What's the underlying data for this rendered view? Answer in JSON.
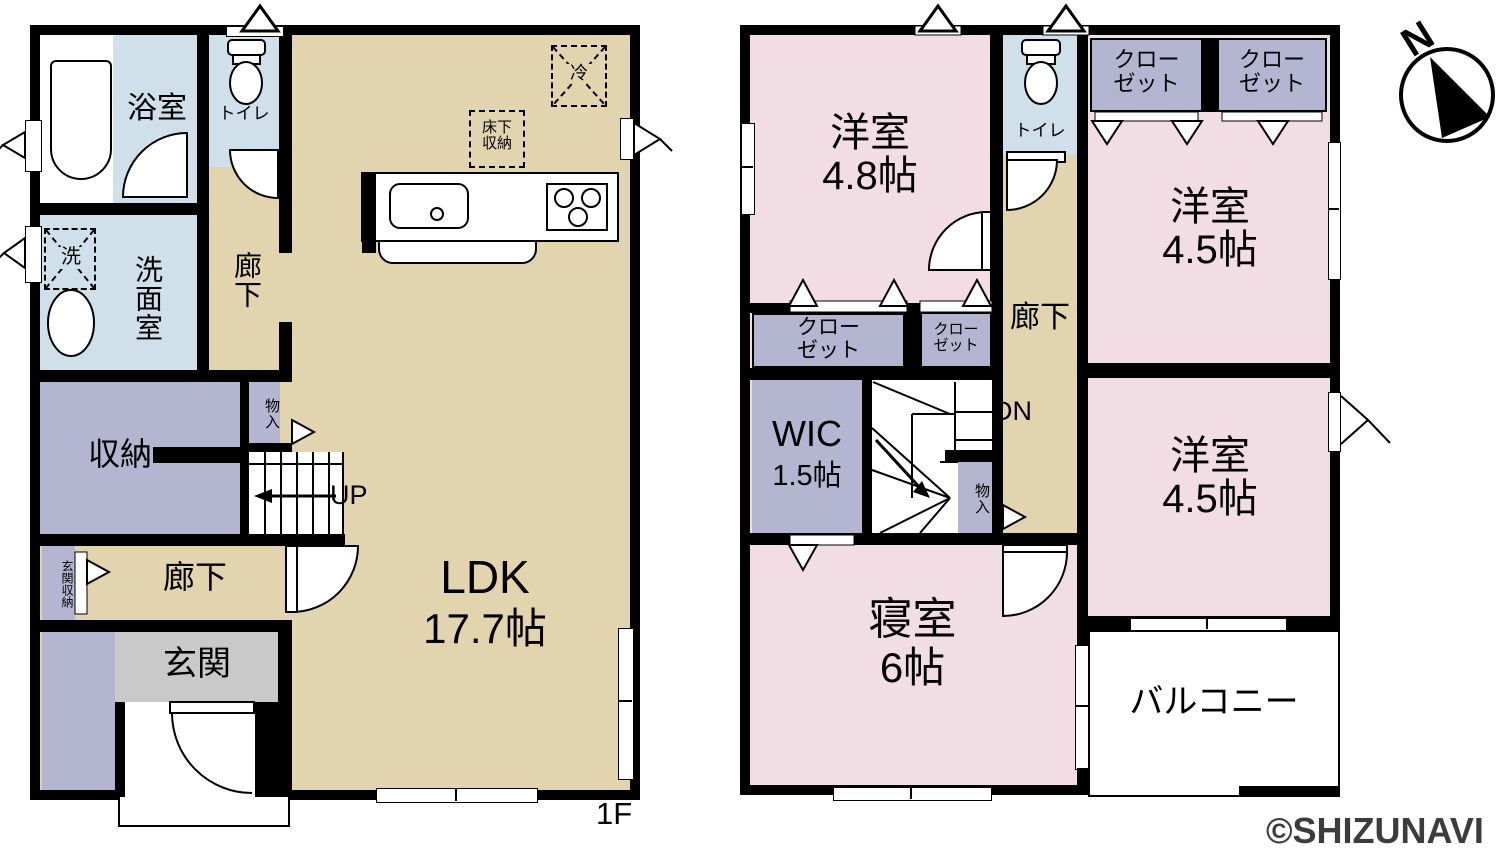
{
  "colors": {
    "wall": "#000000",
    "floor_tan": "#e2d4ae",
    "wet_area_blue": "#cfe0ea",
    "storage_lavender": "#b4b6d1",
    "room_pink": "#f2dde5",
    "entrance_gray": "#c9c9c9",
    "watermark_gray": "#3c3c3c"
  },
  "compass": {
    "north_label": "N"
  },
  "watermark": {
    "text": "©SHIZUNAVI"
  },
  "floor1": {
    "floor_label": "1F",
    "rooms": {
      "bath": "浴室",
      "toilet": "トイレ",
      "hall_upper": "廊下",
      "washroom": "洗面室",
      "washer": "洗",
      "storage": "収納",
      "closet_small": "物入",
      "stairs_up": "UP",
      "entry_storage": "玄関収納",
      "hall_lower": "廊下",
      "entrance": "玄関",
      "ldk_name": "LDK",
      "ldk_size": "17.7帖",
      "underfloor_line1": "床下",
      "underfloor_line2": "収納",
      "fridge": "冷"
    }
  },
  "floor2": {
    "rooms": {
      "western_room_48_name": "洋室",
      "western_room_48_size": "4.8帖",
      "toilet": "トイレ",
      "hall": "廊下",
      "closet_line1": "クロー",
      "closet_line2": "ゼット",
      "western_room_45a_name": "洋室",
      "western_room_45a_size": "4.5帖",
      "western_room_45b_name": "洋室",
      "western_room_45b_size": "4.5帖",
      "wic_name": "WIC",
      "wic_size": "1.5帖",
      "stairs_down": "DN",
      "closet_small": "物入",
      "bedroom_name": "寝室",
      "bedroom_size": "6帖",
      "balcony": "バルコニー"
    }
  }
}
